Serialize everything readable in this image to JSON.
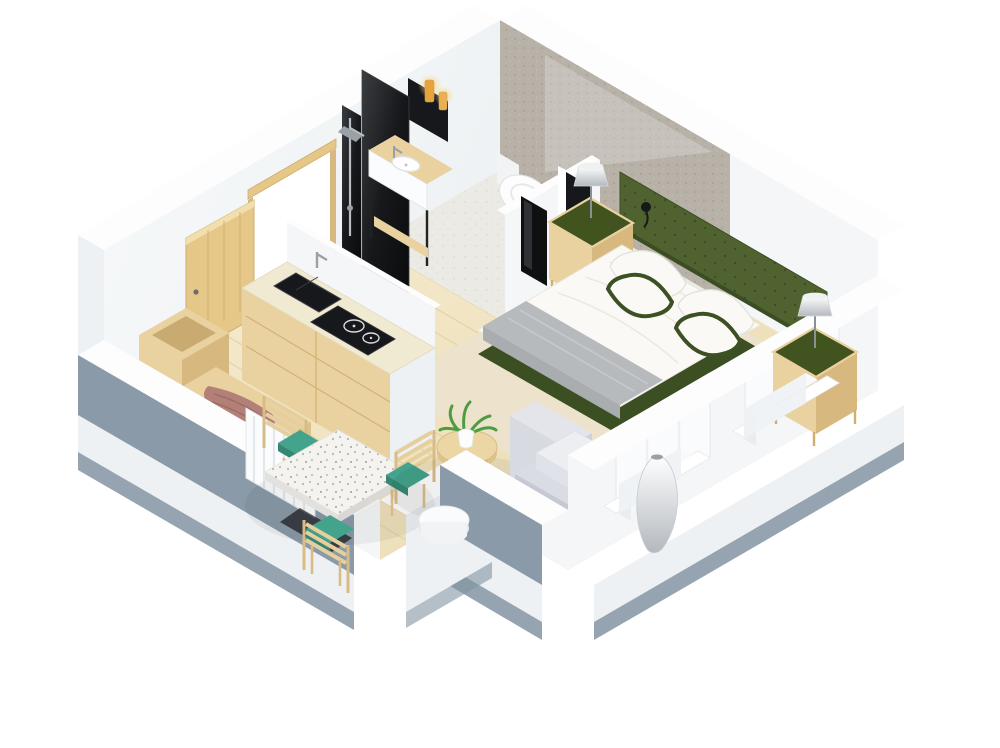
{
  "colors": {
    "background": "#ffffff",
    "wall_face": "#f4f6f8",
    "wall_top": "#fdfdfe",
    "wall_shade": "#eef1f4",
    "slab_side": "#eef1f3",
    "slab_bottom": "#8294a2",
    "low_wall_outer": "#8a9aa8",
    "bath_wall": "#b7b1a8",
    "bath_floor": "#eceae5",
    "glass_black": "#17181b",
    "tv_black": "#0f1011",
    "counter_cream": "#f1ead2",
    "cabinet_wood": "#e9d2a0",
    "wood_dark": "#d7b97f",
    "door_wood": "#e5c788",
    "floor_wood_light": "#f6ecd2",
    "floor_wood_deep": "#ead9ae",
    "plank_line": "#decb9e",
    "headboard_green": "#50622f",
    "green_dark": "#3c4f22",
    "nightstand_top": "#41541f",
    "bed_white": "#faf9f5",
    "throw_gray": "#b7babd",
    "teal": "#43a38c",
    "mauve": "#b28077",
    "rug": "#ede3cd",
    "armchair": "#dadce3",
    "plant_green": "#4e9c42",
    "candle_amber": "#e8a43c",
    "terrazzo_base": "#f4f3f0",
    "chrome": "#b9bec2"
  },
  "scene": {
    "type": "3d-isometric-floor-plan",
    "label": "Studio apartment 3D floor plan",
    "rooms": {
      "entry": {
        "label": "Entry hall"
      },
      "kitchen": {
        "label": "Kitchenette"
      },
      "bathroom": {
        "label": "Bathroom"
      },
      "dining": {
        "label": "Dining nook"
      },
      "living": {
        "label": "Living area"
      },
      "bedroom": {
        "label": "Bedroom area"
      }
    },
    "furniture": {
      "door": {
        "label": "Entrance door (open)"
      },
      "storagebox": {
        "label": "Entry storage chest"
      },
      "bench": {
        "label": "Entry bench"
      },
      "blanket": {
        "label": "Throw blanket"
      },
      "radiator": {
        "label": "Radiator"
      },
      "counter": {
        "label": "Kitchen counter"
      },
      "sink": {
        "label": "Kitchen sink"
      },
      "cooktop": {
        "label": "Two-burner cooktop"
      },
      "shower": {
        "label": "Walk-in shower with black glass screen"
      },
      "vanity": {
        "label": "Bathroom vanity with basin"
      },
      "mirror": {
        "label": "Black mirror with candles"
      },
      "candles": {
        "label": "Amber candles"
      },
      "toilet": {
        "label": "Wall-hung toilet"
      },
      "bathdoor": {
        "label": "Dark bathroom door"
      },
      "tvpanel": {
        "label": "Wall-mounted TV"
      },
      "table": {
        "label": "Terrazzo dining table"
      },
      "chair1": {
        "label": "Dining chair"
      },
      "chair2": {
        "label": "Dining chair"
      },
      "chair3": {
        "label": "Dining chair"
      },
      "sidetable": {
        "label": "Round wooden side table"
      },
      "plant": {
        "label": "Potted plant"
      },
      "coffeetable": {
        "label": "Black accent table"
      },
      "stool": {
        "label": "White side stool"
      },
      "armchair": {
        "label": "Lounge armchair"
      },
      "floorlamp": {
        "label": "Sculptural floor lamp"
      },
      "rug": {
        "label": "Area rug"
      },
      "bed": {
        "label": "Double bed"
      },
      "headboard": {
        "label": "Green tufted headboard"
      },
      "nightstand1": {
        "label": "Nightstand with lamp"
      },
      "nightstand2": {
        "label": "Nightstand with lamp"
      },
      "lamp1": {
        "label": "Table lamp"
      },
      "lamp2": {
        "label": "Table lamp"
      },
      "window1": {
        "label": "Window"
      },
      "window2": {
        "label": "Window"
      }
    }
  }
}
